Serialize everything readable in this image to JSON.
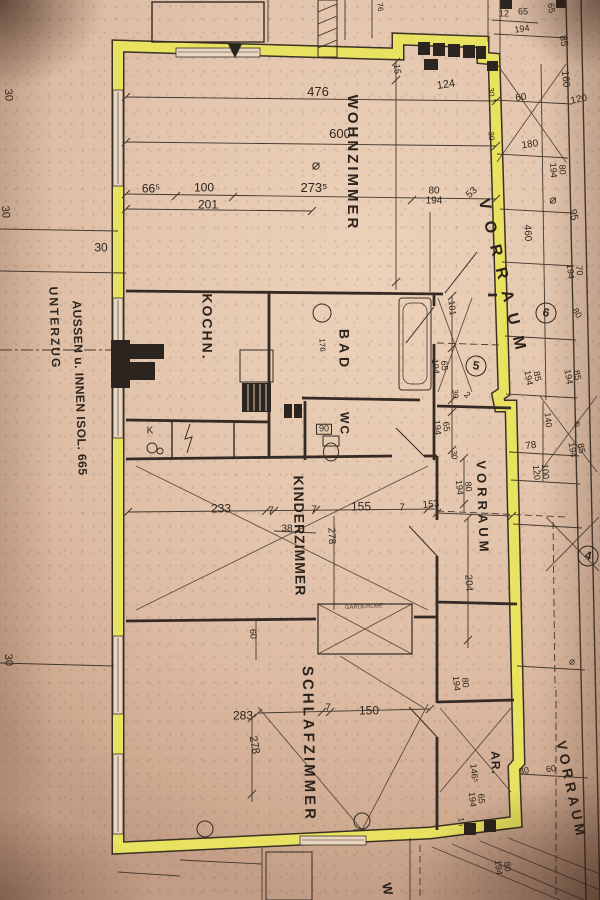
{
  "meta": {
    "kind": "photographed floor plan",
    "language": "de"
  },
  "colors": {
    "paper": "#e5c7af",
    "wall_highlight": "#e8e25c",
    "ink": "#2e251e"
  },
  "plan": {
    "labels": [
      {
        "t": "WOHNZIMMER",
        "x": 352,
        "y": 163,
        "r": 90,
        "s": 15,
        "ls": 3,
        "c": "room",
        "n": "room-label-wohnzimmer"
      },
      {
        "t": "KOCHN.",
        "x": 207,
        "y": 327,
        "r": 90,
        "s": 14,
        "ls": 2,
        "c": "room",
        "n": "room-label-kochnische"
      },
      {
        "t": "BAD",
        "x": 344,
        "y": 350,
        "r": 90,
        "s": 14,
        "ls": 4,
        "c": "room",
        "n": "room-label-bad"
      },
      {
        "t": "WC",
        "x": 344,
        "y": 424,
        "r": 90,
        "s": 12,
        "ls": 2,
        "c": "room",
        "n": "room-label-wc"
      },
      {
        "t": "KINDERZIMMER",
        "x": 299,
        "y": 536,
        "r": 89,
        "s": 14,
        "ls": 1,
        "c": "room",
        "n": "room-label-kinderzimmer"
      },
      {
        "t": "SCHLAFZIMMER",
        "x": 308,
        "y": 744,
        "r": 89,
        "s": 15,
        "ls": 3,
        "c": "room",
        "n": "room-label-schlafzimmer"
      },
      {
        "t": "AR.",
        "x": 495,
        "y": 763,
        "r": 88,
        "s": 12,
        "ls": 1,
        "c": "room",
        "n": "room-label-abstellraum"
      },
      {
        "t": "VORRAUM",
        "x": 503,
        "y": 280,
        "r": 76,
        "s": 16,
        "ls": 12,
        "c": "room",
        "n": "room-label-vorraum-top"
      },
      {
        "t": "VORRAUM",
        "x": 482,
        "y": 508,
        "r": 88,
        "s": 13,
        "ls": 4,
        "c": "room",
        "n": "room-label-vorraum-mid"
      },
      {
        "t": "VORRAUM",
        "x": 571,
        "y": 790,
        "r": 78,
        "s": 14,
        "ls": 4,
        "c": "room",
        "n": "room-label-vorraum-bottom"
      },
      {
        "t": "UNTERZUG",
        "x": 54,
        "y": 328,
        "r": 88,
        "s": 12,
        "ls": 2,
        "c": "note",
        "n": "margin-note-unterzug"
      },
      {
        "t": "AUSSEN u. INNEN ISOL. 665",
        "x": 79,
        "y": 388,
        "r": 88,
        "s": 12,
        "ls": 0.5,
        "c": "note",
        "n": "margin-note-isolierung"
      },
      {
        "t": "GARDEROBE",
        "x": 364,
        "y": 608,
        "r": -3,
        "s": 6,
        "c": "tiny",
        "n": "fixture-label-garderobe"
      },
      {
        "t": "K",
        "x": 150,
        "y": 431,
        "r": 0,
        "s": 10,
        "c": "dim",
        "n": "fixture-label-k"
      },
      {
        "t": "W",
        "x": 387,
        "y": 889,
        "r": 80,
        "s": 13,
        "c": "room",
        "n": "room-label-cutoff"
      },
      {
        "t": "30",
        "x": 101,
        "y": 248,
        "r": 0,
        "s": 12
      },
      {
        "t": "476",
        "x": 318,
        "y": 92,
        "r": 0,
        "s": 13
      },
      {
        "t": "600",
        "x": 340,
        "y": 134,
        "r": 0,
        "s": 13
      },
      {
        "t": "⌀",
        "x": 316,
        "y": 165,
        "r": 0,
        "s": 14
      },
      {
        "t": "273⁵",
        "x": 314,
        "y": 188,
        "r": 0,
        "s": 13
      },
      {
        "t": "66⁵",
        "x": 151,
        "y": 189,
        "r": 0,
        "s": 12
      },
      {
        "t": "100",
        "x": 204,
        "y": 188,
        "r": 0,
        "s": 12
      },
      {
        "t": "201",
        "x": 208,
        "y": 205,
        "r": 0,
        "s": 12
      },
      {
        "t": "80\n194",
        "x": 434,
        "y": 196,
        "r": 0,
        "s": 10
      },
      {
        "t": "53",
        "x": 472,
        "y": 193,
        "r": -42,
        "s": 10
      },
      {
        "t": "124",
        "x": 446,
        "y": 85,
        "r": -8,
        "s": 11
      },
      {
        "t": "15",
        "x": 397,
        "y": 69,
        "r": 85,
        "s": 9
      },
      {
        "t": "12",
        "x": 504,
        "y": 14,
        "r": 0,
        "s": 9
      },
      {
        "t": "65",
        "x": 523,
        "y": 12,
        "r": 0,
        "s": 9
      },
      {
        "t": "194",
        "x": 522,
        "y": 29,
        "r": -8,
        "s": 9
      },
      {
        "t": "65",
        "x": 551,
        "y": 8,
        "r": 80,
        "s": 9
      },
      {
        "t": "85",
        "x": 563,
        "y": 41,
        "r": 80,
        "s": 10
      },
      {
        "t": "160",
        "x": 565,
        "y": 79,
        "r": 84,
        "s": 10
      },
      {
        "t": "120",
        "x": 579,
        "y": 100,
        "r": -12,
        "s": 10
      },
      {
        "t": "60",
        "x": 521,
        "y": 98,
        "r": -8,
        "s": 10
      },
      {
        "t": "30",
        "x": 491,
        "y": 92,
        "r": 85,
        "s": 8
      },
      {
        "t": "30",
        "x": 491,
        "y": 136,
        "r": 85,
        "s": 8
      },
      {
        "t": "180",
        "x": 530,
        "y": 145,
        "r": -8,
        "s": 10
      },
      {
        "t": "80\n194",
        "x": 558,
        "y": 170,
        "r": 86,
        "s": 9
      },
      {
        "t": "⌀",
        "x": 553,
        "y": 200,
        "r": 0,
        "s": 12
      },
      {
        "t": "95",
        "x": 573,
        "y": 215,
        "r": 78,
        "s": 10
      },
      {
        "t": "460",
        "x": 527,
        "y": 233,
        "r": 87,
        "s": 10
      },
      {
        "t": "70\n194",
        "x": 575,
        "y": 271,
        "r": 84,
        "s": 9
      },
      {
        "t": "80",
        "x": 577,
        "y": 313,
        "r": 58,
        "s": 9
      },
      {
        "t": "101",
        "x": 452,
        "y": 308,
        "r": 84,
        "s": 9
      },
      {
        "t": "65\n194",
        "x": 440,
        "y": 366,
        "r": 84,
        "s": 9
      },
      {
        "t": "30",
        "x": 455,
        "y": 394,
        "r": 84,
        "s": 8
      },
      {
        "t": "2",
        "x": 467,
        "y": 395,
        "r": 40,
        "s": 9
      },
      {
        "t": "65\n194",
        "x": 442,
        "y": 427,
        "r": 84,
        "s": 9
      },
      {
        "t": "30",
        "x": 454,
        "y": 455,
        "r": 84,
        "s": 8
      },
      {
        "t": "80\n194",
        "x": 464,
        "y": 487,
        "r": 84,
        "s": 9
      },
      {
        "t": "85\n194",
        "x": 533,
        "y": 377,
        "r": 80,
        "s": 9
      },
      {
        "t": "85\n194",
        "x": 573,
        "y": 376,
        "r": 80,
        "s": 9
      },
      {
        "t": "140",
        "x": 548,
        "y": 420,
        "r": 84,
        "s": 9
      },
      {
        "t": "78",
        "x": 531,
        "y": 446,
        "r": -8,
        "s": 10
      },
      {
        "t": "85\n194",
        "x": 577,
        "y": 449,
        "r": 80,
        "s": 9
      },
      {
        "t": "100\n120",
        "x": 541,
        "y": 472,
        "r": 84,
        "s": 9
      },
      {
        "t": "⌀",
        "x": 577,
        "y": 424,
        "r": 0,
        "s": 10
      },
      {
        "t": "153",
        "x": 431,
        "y": 505,
        "r": -5,
        "s": 10
      },
      {
        "t": "204",
        "x": 468,
        "y": 583,
        "r": 87,
        "s": 10
      },
      {
        "t": "233",
        "x": 221,
        "y": 509,
        "r": 0,
        "s": 12
      },
      {
        "t": "7",
        "x": 271,
        "y": 511,
        "r": 0,
        "s": 10
      },
      {
        "t": "38",
        "x": 287,
        "y": 529,
        "r": 0,
        "s": 10
      },
      {
        "t": "7",
        "x": 314,
        "y": 510,
        "r": 0,
        "s": 10
      },
      {
        "t": "155",
        "x": 361,
        "y": 507,
        "r": 0,
        "s": 12
      },
      {
        "t": "7",
        "x": 402,
        "y": 508,
        "r": 0,
        "s": 10
      },
      {
        "t": "278",
        "x": 331,
        "y": 536,
        "r": 87,
        "s": 10
      },
      {
        "t": "60",
        "x": 253,
        "y": 634,
        "r": 84,
        "s": 9
      },
      {
        "t": "176",
        "x": 322,
        "y": 345,
        "r": 87,
        "s": 8
      },
      {
        "t": "90",
        "x": 324,
        "y": 429,
        "r": 0,
        "s": 9,
        "c": "boxed",
        "n": "boxed-dimension-90"
      },
      {
        "t": "283",
        "x": 243,
        "y": 716,
        "r": 0,
        "s": 12
      },
      {
        "t": "278",
        "x": 254,
        "y": 745,
        "r": 80,
        "s": 11
      },
      {
        "t": "150",
        "x": 369,
        "y": 711,
        "r": 0,
        "s": 12
      },
      {
        "t": "7",
        "x": 328,
        "y": 708,
        "r": 0,
        "s": 10
      },
      {
        "t": "146⁵",
        "x": 474,
        "y": 773,
        "r": 84,
        "s": 9
      },
      {
        "t": "65\n194",
        "x": 477,
        "y": 799,
        "r": 84,
        "s": 9
      },
      {
        "t": "15",
        "x": 461,
        "y": 822,
        "r": 84,
        "s": 8
      },
      {
        "t": "30",
        "x": 524,
        "y": 771,
        "r": -8,
        "s": 9
      },
      {
        "t": "60",
        "x": 551,
        "y": 769,
        "r": -8,
        "s": 9
      },
      {
        "t": "80\n194",
        "x": 503,
        "y": 867,
        "r": 84,
        "s": 9
      },
      {
        "t": "80\n194",
        "x": 461,
        "y": 683,
        "r": 84,
        "s": 9
      },
      {
        "t": "30",
        "x": 8,
        "y": 95,
        "r": 85,
        "s": 11
      },
      {
        "t": "30",
        "x": 5,
        "y": 212,
        "r": 85,
        "s": 11
      },
      {
        "t": "30",
        "x": 8,
        "y": 660,
        "r": 85,
        "s": 11
      },
      {
        "t": "76",
        "x": 380,
        "y": 7,
        "r": 85,
        "s": 8
      },
      {
        "t": "⌀",
        "x": 572,
        "y": 662,
        "r": 0,
        "s": 10
      },
      {
        "t": "6",
        "x": 546,
        "y": 313,
        "r": 15,
        "s": 12,
        "c": "circled",
        "n": "position-marker-6"
      },
      {
        "t": "5",
        "x": 476,
        "y": 366,
        "r": 10,
        "s": 12,
        "c": "circled",
        "n": "position-marker-5"
      },
      {
        "t": "4",
        "x": 588,
        "y": 556,
        "r": 15,
        "s": 12,
        "c": "circled",
        "n": "position-marker-4"
      }
    ]
  }
}
